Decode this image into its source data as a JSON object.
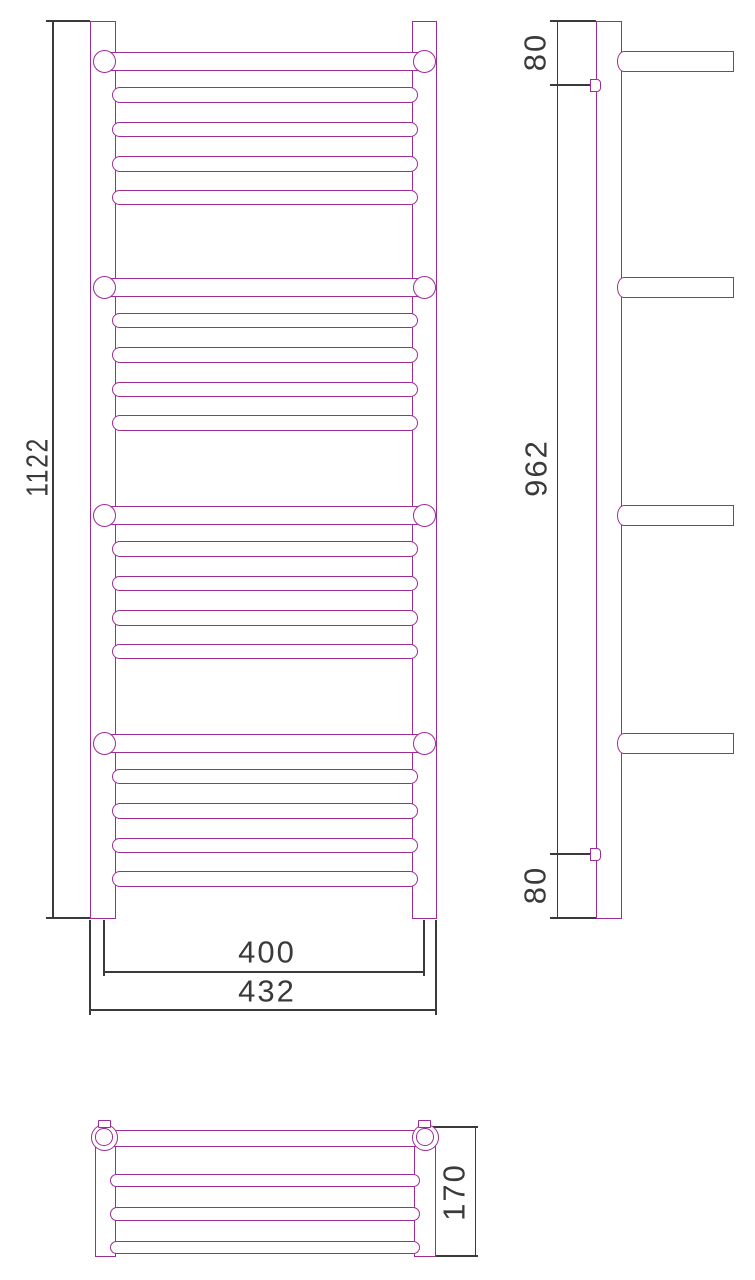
{
  "colors": {
    "outline": "#9C2C96",
    "dimension": "#3A3A3A",
    "background": "#FFFFFF"
  },
  "dimensions": {
    "front_height": "1122",
    "front_tube_span": "400",
    "front_overall_width": "432",
    "side_top_offset": "80",
    "side_bracket_span": "962",
    "side_bottom_offset": "80",
    "top_depth": "170"
  }
}
